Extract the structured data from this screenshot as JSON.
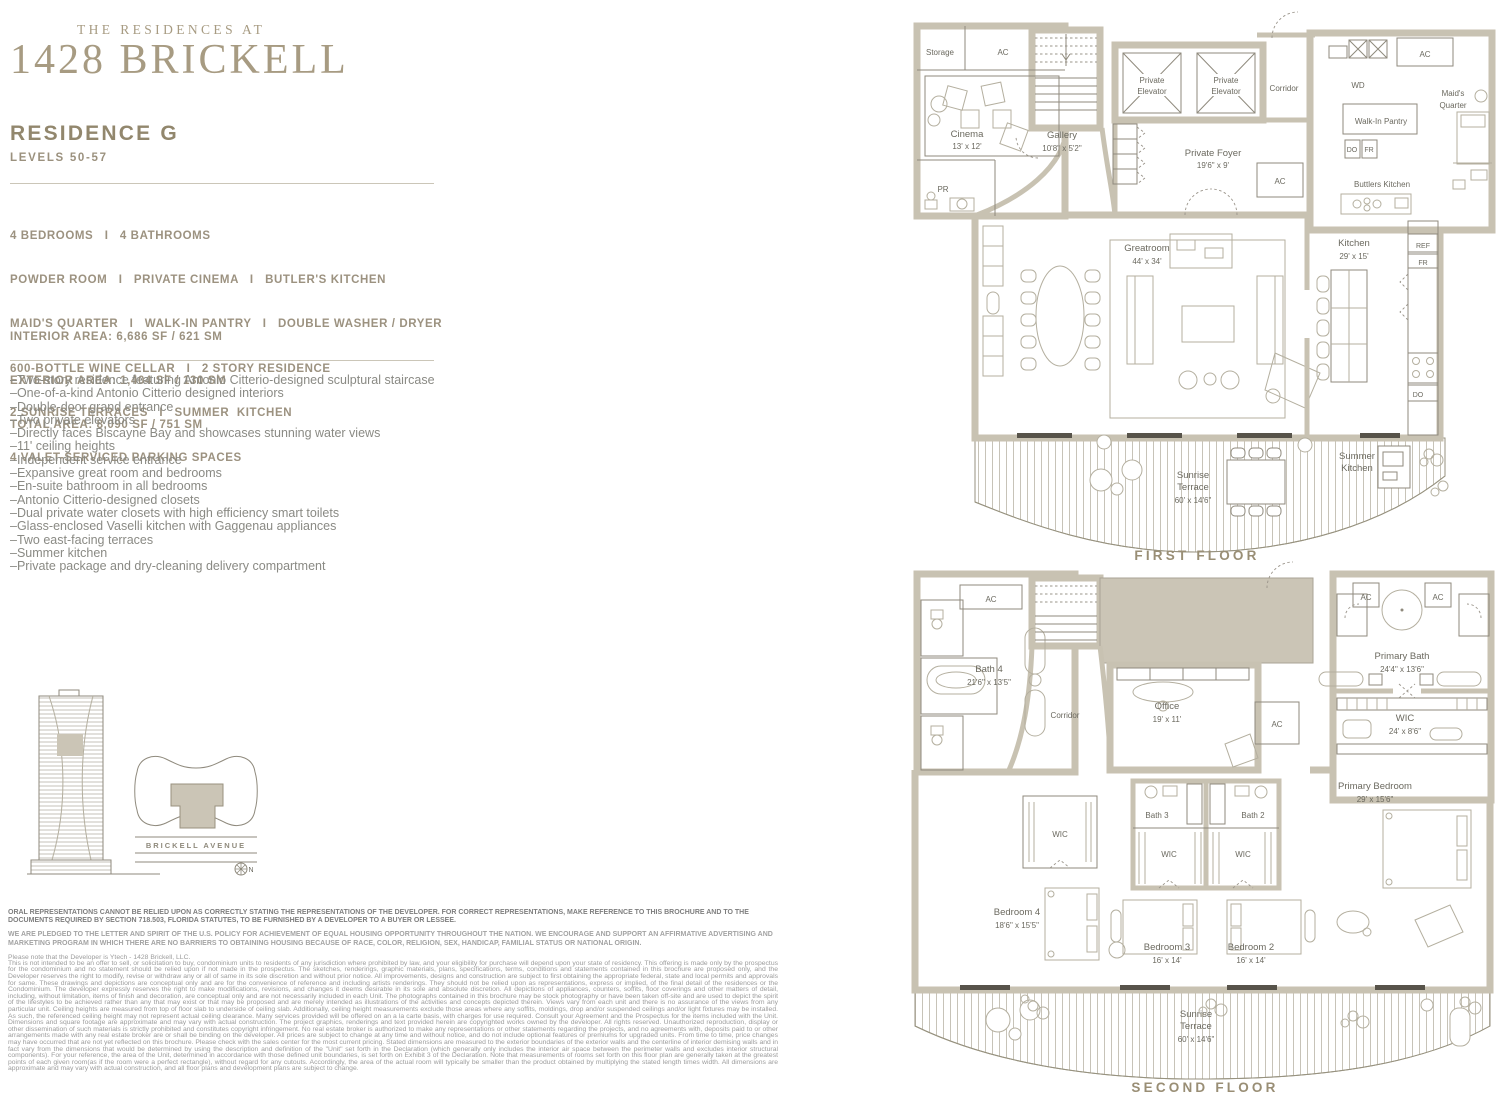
{
  "brand": {
    "eyebrow": "THE RESIDENCES AT",
    "name": "1428 BRICKELL"
  },
  "residence": {
    "name": "RESIDENCE G",
    "levels": "LEVELS 50-57"
  },
  "specs": [
    "4 BEDROOMS   I   4 BATHROOMS",
    "POWDER ROOM   I   PRIVATE CINEMA   I   BUTLER'S KITCHEN",
    "MAID'S QUARTER   I   WALK-IN PANTRY   I   DOUBLE WASHER / DRYER",
    "600-BOTTLE WINE CELLAR   I   2 STORY RESIDENCE",
    "2 SUNRISE TERRACES   I   SUMMER  KITCHEN",
    "4 VALET-SERVICED PARKING SPACES"
  ],
  "areas": [
    "INTERIOR AREA: 6,686 SF / 621 SM",
    "EXTERIOR AREA: 1,404 SF / 130 SM",
    "TOTAL AREA: 8,090 SF / 751 SM"
  ],
  "bullets": [
    "–Two-story residence featuring Antonio Citterio-designed sculptural staircase",
    "–One-of-a-kind Antonio Citterio designed interiors",
    "–Double-door grand entrance",
    "–Two private elevators",
    "–Directly faces Biscayne Bay and showcases stunning water views",
    "–11' ceiling heights",
    "–Independent service entrance",
    "–Expansive great room and bedrooms",
    "–En-suite bathroom in all bedrooms",
    "–Antonio Citterio-designed closets",
    "–Dual private water closets with high efficiency smart toilets",
    "–Glass-enclosed Vaselli kitchen with Gaggenau appliances",
    "–Two east-facing terraces",
    "–Summer kitchen",
    "–Private package and dry-cleaning delivery compartment"
  ],
  "keyplan": {
    "street": "BRICKELL AVENUE",
    "north": "N"
  },
  "legal": {
    "bold1": "ORAL REPRESENTATIONS CANNOT BE RELIED UPON AS CORRECTLY STATING THE REPRESENTATIONS OF THE DEVELOPER. FOR CORRECT REPRESENTATIONS, MAKE REFERENCE TO THIS BROCHURE AND TO THE DOCUMENTS REQUIRED BY SECTION 718.503, FLORIDA STATUTES, TO BE FURNISHED BY A DEVELOPER TO A BUYER OR LESSEE.",
    "bold2": "WE ARE PLEDGED TO THE LETTER AND SPIRIT OF THE U.S. POLICY FOR ACHIEVEMENT OF EQUAL HOUSING OPPORTUNITY THROUGHOUT THE NATION. WE ENCOURAGE AND SUPPORT AN AFFIRMATIVE ADVERTISING AND MARKETING PROGRAM IN WHICH THERE ARE NO BARRIERS TO OBTAINING HOUSING BECAUSE OF RACE, COLOR, RELIGION, SEX, HANDICAP, FAMILIAL STATUS OR NATIONAL ORIGIN.",
    "note": "Please note that the Developer is Ytech - 1428 Brickell, LLC.",
    "body": "This is not intended to be an offer to sell, or solicitation to buy, condominium units to residents of any jurisdiction where prohibited by law, and your eligibility for purchase will depend upon your state of residency. This offering is made only by the prospectus for the condominium and no statement should be relied upon if not made in the prospectus. The sketches, renderings, graphic materials, plans, specifications, terms, conditions and statements contained in this brochure are proposed only, and the Developer reserves the right to modify, revise or withdraw any or all of same in its sole discretion and without prior notice. All improvements, designs and construction are subject to first obtaining the appropriate federal, state and local permits and approvals for same. These drawings and depictions are conceptual only and are for the convenience of reference and including artists renderings. They should not be relied upon as representations, express or implied, of the final detail of the residences or the Condominium. The developer expressly reserves the right to make modifications, revisions, and changes it deems desirable in its sole and absolute discretion. All depictions of appliances, counters, soffits, floor coverings and other matters of detail, including, without limitation, items of finish and decoration, are conceptual only and are not necessarily included in each Unit. The photographs contained in this brochure may be stock photography or have been taken off-site and are used to depict the spirit of the lifestyles to be achieved rather than any that may exist or that may be proposed and are merely intended as illustrations of the activities and concepts depicted therein. Views vary from each unit and there is no assurance of the views from any particular unit. Ceiling heights are measured from top of floor slab to underside of ceiling slab. Additionally, ceiling height measurements exclude those areas where any soffits, moldings, drop and/or suspended ceilings and/or light fixtures may be installed. As such, the referenced ceiling height may not represent actual ceiling clearance. Many services provided will be offered on an a la carte basis, with charges for use required. Consult your Agreement and the Prospectus for the items included with the Unit. Dimensions and square footage are approximate and may vary with actual construction. The project graphics, renderings and text provided herein are copyrighted works owned by the developer. All rights reserved. Unauthorized reproduction, display or other dissemination of such materials is strictly prohibited and constitutes copyright infringement. No real estate broker is authorized to make any representations or other statements regarding the projects, and no agreements with, deposits paid to or other arrangements made with any real estate broker are or shall be binding on the developer. All prices are subject to change at any time and without notice, and do not include optional features or premiums for upgraded units. From time to time, price changes may have occurred that are not yet reflected on this brochure. Please check with the sales center for the most current pricing. Stated dimensions are measured to the exterior boundaries of the exterior walls and the centerline of interior demising walls and in fact vary from the dimensions that would be determined by using the description and definition of the \"Unit\" set forth in the Declaration (which generally only includes the interior air space between the perimeter walls and excludes interior structural components). For your reference, the area of the Unit, determined in accordance with those defined unit boundaries, is set forth on Exhibit 3 of the Declaration. Note that measurements of rooms set forth on this floor plan are generally taken at the greatest points of each given room(as if the room were a perfect rectangle), without regard for any cutouts. Accordingly, the area of the actual room will typically be smaller than the product obtained by multiplying the stated length times width. All dimensions are approximate and may vary with actual construction, and all floor plans and development plans are subject to change."
  },
  "ff": {
    "caption": "FIRST FLOOR",
    "storage": "Storage",
    "ac": "AC",
    "pr": "PR",
    "cinema": "Cinema",
    "cinema_d": "13' x 12'",
    "gallery": "Gallery",
    "gallery_d": "10'8\" x 5'2\"",
    "elev1": "Private",
    "elev2": "Elevator",
    "corridor": "Corridor",
    "wd": "WD",
    "maids1": "Maid's",
    "maids2": "Quarter",
    "pantry": "Walk-In Pantry",
    "do": "DO",
    "fr": "FR",
    "butlers": "Buttlers Kitchen",
    "foyer": "Private Foyer",
    "foyer_d": "19'6\" x 9'",
    "great": "Greatroom",
    "great_d": "44' x 34'",
    "kitchen": "Kitchen",
    "kitchen_d": "29' x 15'",
    "ref": "REF",
    "sun1": "Sunrise",
    "sun2": "Terrace",
    "sun_d": "60' x 14'6\"",
    "summer1": "Summer",
    "summer2": "Kitchen"
  },
  "sf": {
    "caption": "SECOND FLOOR",
    "ac": "AC",
    "bath4": "Bath 4",
    "bath4_d": "21'6\" x 13'5\"",
    "corridor": "Corridor",
    "office": "Office",
    "office_d": "19' x 11'",
    "pbath": "Primary Bath",
    "pbath_d": "24'4\" x 13'6\"",
    "wic": "WIC",
    "wic_d": "24' x 8'6\"",
    "bath3": "Bath 3",
    "bath2": "Bath 2",
    "bed4": "Bedroom 4",
    "bed4_d": "18'6\" x 15'5\"",
    "bed3": "Bedroom 3",
    "bed3_d": "16' x 14'",
    "bed2": "Bedroom 2",
    "bed2_d": "16' x 14'",
    "pbed": "Primary Bedroom",
    "pbed_d": "29' x 15'6\"",
    "sun1": "Sunrise",
    "sun2": "Terrace",
    "sun_d": "60' x 14'6\""
  }
}
